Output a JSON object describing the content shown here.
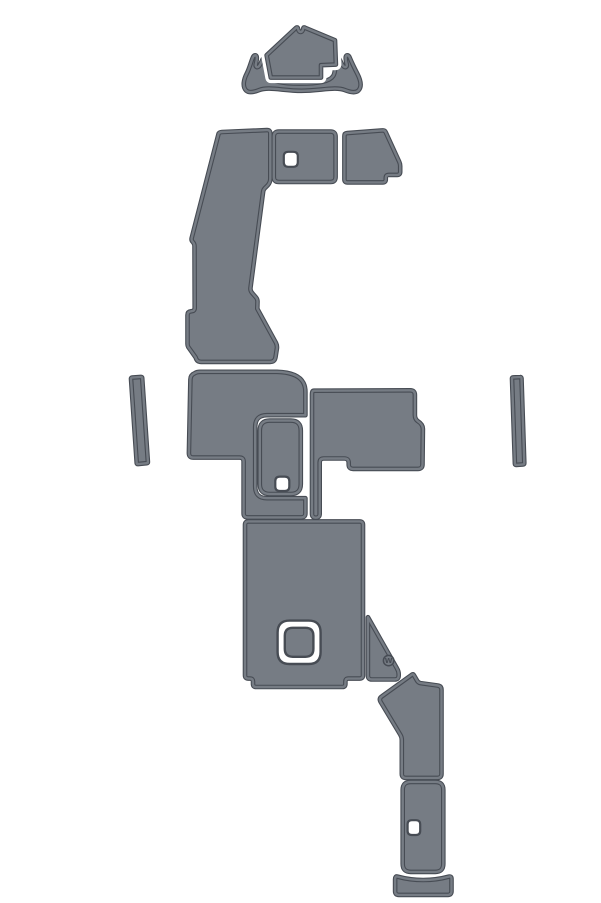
{
  "palette": {
    "background": "#ffffff",
    "pad_fill": "#767c84",
    "pad_edge": "#474c54",
    "hole_fill": "#ffffff"
  },
  "pieces": [
    {
      "id": "bow-deck-pad",
      "d": "M270.8,77.6 L266.6,55.2 L295.9,27.9 C296.9,27.0 297.8,27.3 298.0,28.6 C298.3,30.6 299.3,32.0 300.6,32.0 C301.9,32.0 302.9,30.6 303.2,28.6 C303.4,27.3 304.3,27.0 305.3,27.9 L335.0,40.2 L335.9,64.6 L321.0,65.2 L321.0,77.6 Z"
    },
    {
      "id": "bow-trim-pad",
      "d": "M246.2,90.6 C242.2,86.6 243.6,79.6 246.8,73.4 C249.4,68.4 250.8,62.4 252.8,57.6 C253.8,55.2 255.8,54.4 256.6,56.4 C257.4,58.4 256.4,61.6 255.8,64.2 C255.2,66.8 257.0,68.0 258.8,66.4 C261.0,64.4 261.6,59.8 263.8,57.6 C265.6,55.8 267.4,56.8 267.2,59.6 C266.8,64.8 266.2,72.0 268.8,76.0 C272.4,81.6 282.0,83.6 300.0,83.6 C318.0,83.6 329.6,81.6 333.2,76.0 C335.8,72.0 335.2,64.8 334.8,59.6 C334.6,56.8 336.4,55.8 338.2,57.6 C340.4,59.8 341.5,64.4 343.7,66.4 C345.5,68.0 347.3,66.8 346.7,64.2 C346.1,61.6 345.1,58.4 345.9,56.4 C346.7,54.4 348.7,55.2 349.7,57.6 C351.7,62.4 354.6,68.4 357.2,73.4 C360.4,79.6 362.3,86.6 358.3,90.6 C355.3,93.4 349.6,92.0 344.6,90.0 C335.6,86.4 319.5,90.8 301.5,90.8 C283.5,90.8 268.4,86.4 259.4,90.0 C254.4,92.0 249.2,93.4 246.2,90.6 Z"
    },
    {
      "id": "port-gunwale-pad",
      "d": "M221.9,132 L266.9,130.1 Q270.3,130 270.3,133.4 L270.3,178.5 Q270.3,182.5 267.8,185.2 L264.9,188.1 Q263.4,189.7 263.1,191.9 L250.5,287.7 Q250.1,290.5 251.9,292.7 L256.1,297.5 Q257.7,299.5 257.5,302.1 L257.3,308.7 L275.9,342.7 Q277.3,345.5 276.9,348.5 L275.5,357.3 Q274.7,361.9 270.1,361.9 L201.3,361.9 Q196.7,361.9 195.7,357.5 L188.3,347.1 Q187.5,345.7 187.5,343.9 L187.5,315.1 Q187.5,311.7 190.9,311.3 L192.1,311.1 Q194.7,310.7 194.7,308.1 L194.5,246.3 Q194.5,243.7 192.7,241.9 Q191.1,240.3 191.7,237.9 L218.5,133.9 Q219.1,132.2 221.9,132 Z"
    },
    {
      "id": "helm-box-pad",
      "d": "M278.8,131.6 L330.6,131.6 Q335.6,131.6 335.6,136.6 L335.6,177 Q335.6,182 330.6,182 L278.8,182 Q273.8,182 273.8,177 L273.8,136.6 Q273.8,131.6 278.8,131.6 Z",
      "hole": "M288.3,151.8 L293.3,151.8 Q297.8,151.8 297.8,156.3 L297.8,162.3 Q297.8,166.8 293.3,166.8 L288.3,166.8 Q283.8,166.8 283.8,162.3 L283.8,156.3 Q283.8,151.8 288.3,151.8 Z"
    },
    {
      "id": "starboard-upper-pad",
      "d": "M347.2,133.1 L382.6,130.4 Q384.8,130.2 385.7,132.2 L399.3,161.9 Q400.2,163.9 400.2,166.1 L400.2,171.9 Q400.2,174.9 397.2,174.9 L388.8,174.9 Q385.8,174.9 385.8,177.9 L385.8,179.4 Q385.8,182.4 382.8,182.4 L347.4,182.4 Q344.4,182.4 344.4,179.4 L344.4,136.1 Q344.4,133.3 347.2,133.1 Z"
    },
    {
      "id": "port-side-strip",
      "d": "M132.1,377.6 L140.9,376.9 Q142.1,376.8 142.2,378 L147.9,461.9 Q148,463.1 146.8,463.2 L138,464.1 Q136.8,464.2 136.7,463 L131,378.9 Q130.9,377.7 132.1,377.6 Z"
    },
    {
      "id": "starboard-side-strip",
      "d": "M513,377.4 L520.2,377.1 Q521.4,377 521.5,378.2 L524.3,463.1 Q524.3,464.3 523.1,464.4 L516.2,464.9 Q515,465 514.9,463.8 L512,378.7 Q511.9,377.5 513,377.4 Z"
    },
    {
      "id": "mid-deck-pad",
      "d": "M200,371.8 L277,371.8 C291,372.2 300.2,376.2 303.6,383.2 C305.2,386.4 305.4,388.8 305.4,392 L305.4,415.2 L267,415.2 Q255.2,415.2 255.2,427 L255.2,486.4 Q255.2,498.2 267,498.2 L305.4,498.2 L305.4,513.4 Q305.4,517.4 301.4,517.4 L247.6,517.4 Q243.6,517.4 243.6,513.4 L243.6,461.6 Q243.6,457.6 239.6,457.6 L193.4,457.6 Q188.9,457.6 188.9,453.1 L190.4,379.4 Q190.5,374.9 194.9,373.1 Q197,371.8 200,371.8 Z"
    },
    {
      "id": "hatch-insert-pad",
      "d": "M269.8,420.6 L290.8,420.6 Q300.8,420.6 300.8,430.6 L300.8,484 Q300.8,494 290.8,494 L269.8,494 Q259.8,494 259.8,484 L259.8,430.6 Q259.8,420.6 269.8,420.6 Z",
      "hole": "M279.8,476.6 L284.8,476.6 Q289.3,476.6 289.3,481.1 L289.3,486.5 Q289.3,491 284.8,491 L279.8,491 Q275.3,491 275.3,486.5 L275.3,481.1 Q275.3,476.6 279.8,476.6 Z"
    },
    {
      "id": "mid-deck-right-pad",
      "d": "M313.9,390.7 L410.3,390.3 Q414.9,390.3 414.9,394.9 L414.9,415.1 Q414.9,418.9 417.7,421.1 Q422.9,424.3 422.9,428.9 L422.5,464.3 Q422.5,468.9 417.9,468.9 L353.1,468.9 Q348.7,468.9 348.7,464.5 L348.7,462.9 Q348.7,458.5 344.3,458.5 L323.7,458.5 Q319.7,458.5 319.7,462.5 L319.7,513.9 Q319.7,517.7 315.8,517.7 Q312,517.7 312,513.9 L312,394.6 Q312,390.7 313.9,390.7 Z"
    },
    {
      "id": "cockpit-sole-pad",
      "d": "M248.4,521.4 L359.6,521.4 Q363,521.4 363,524.8 L363,675.2 Q363,678.6 359.6,678.6 L348.4,678.6 Q345.4,678.6 345.4,681.6 L345.4,684 Q345.4,687 342.4,687 L256,687 Q253,687 253,684 L253,681.6 Q253,678.6 250,678.6 L248.4,678.6 Q245,678.6 245,675.2 L245,524.8 Q245,521.4 248.4,521.4 Z",
      "hatch_outer": "M289.6,620.6 L308.6,620.6 Q320.6,620.6 320.6,632.6 L320.6,652 Q320.6,664 308.6,664 L289.6,664 Q277.6,664 277.6,652 L277.6,632.6 Q277.6,620.6 289.6,620.6 Z",
      "hatch_inner": "M292.8,627.8 L305.4,627.8 Q313.4,627.8 313.4,635.8 L313.4,648.8 Q313.4,656.8 305.4,656.8 L292.8,656.8 Q284.8,656.8 284.8,648.8 L284.8,635.8 Q284.8,627.8 292.8,627.8 Z"
    },
    {
      "id": "corner-wedge-pad",
      "d": "M368,617.3 L396.9,668.3 Q398.7,671.3 398.7,674.1 L398.7,675.5 Q398.7,679.5 394.7,679.5 L371.9,679.5 Q367.9,679.5 367.9,675.5 L367.9,618 Q367.9,616.9 368,617.3 Z",
      "logo": {
        "mark": "W",
        "cx": 388.6,
        "cy": 660.6,
        "r": 5.2,
        "ty": 663.2
      }
    },
    {
      "id": "transom-step-pad",
      "d": "M411.9,674.7 Q413.1,673.7 413.9,675.1 L417.1,680.7 Q418.3,682.7 420.5,683.1 L437.7,685.5 Q441.5,686 441.5,689.9 L441.5,773.9 Q441.5,777.9 437.5,777.9 L405.8,777.9 Q401.8,777.9 401.8,773.9 L401.8,740.1 Q401.8,737.1 400.3,734.7 L380.5,701.7 Q378.9,698.7 381.4,696.7 Z"
    },
    {
      "id": "swim-platform-pad",
      "d": "M410.7,781.9 L435.3,781.9 Q443.3,781.9 443.3,789.9 L443.3,863.9 Q443.3,871.9 435.3,871.9 L410.7,871.9 Q402.7,871.9 402.7,863.9 L402.7,789.9 Q402.7,781.9 410.7,781.9 Z",
      "hole": "M411.8,820.2 L416,820.2 Q420.2,820.2 420.2,824.4 L420.2,830.8 Q420.2,835 416,835 L411.8,835 Q407.6,835 407.6,830.8 L407.6,824.4 Q407.6,820.2 411.8,820.2 Z"
    },
    {
      "id": "transom-trim-pad",
      "d": "M397.5,876.6 Q410,880 423.2,880 Q436.4,880 448.9,876.6 Q451.5,876 451.5,878.8 L451.5,891.3 Q451.5,894.9 447.9,894.9 L398.7,894.9 Q395.1,894.9 395.1,891.3 L395.1,879.2 Q395.1,875.9 397.5,876.6 Z"
    }
  ]
}
